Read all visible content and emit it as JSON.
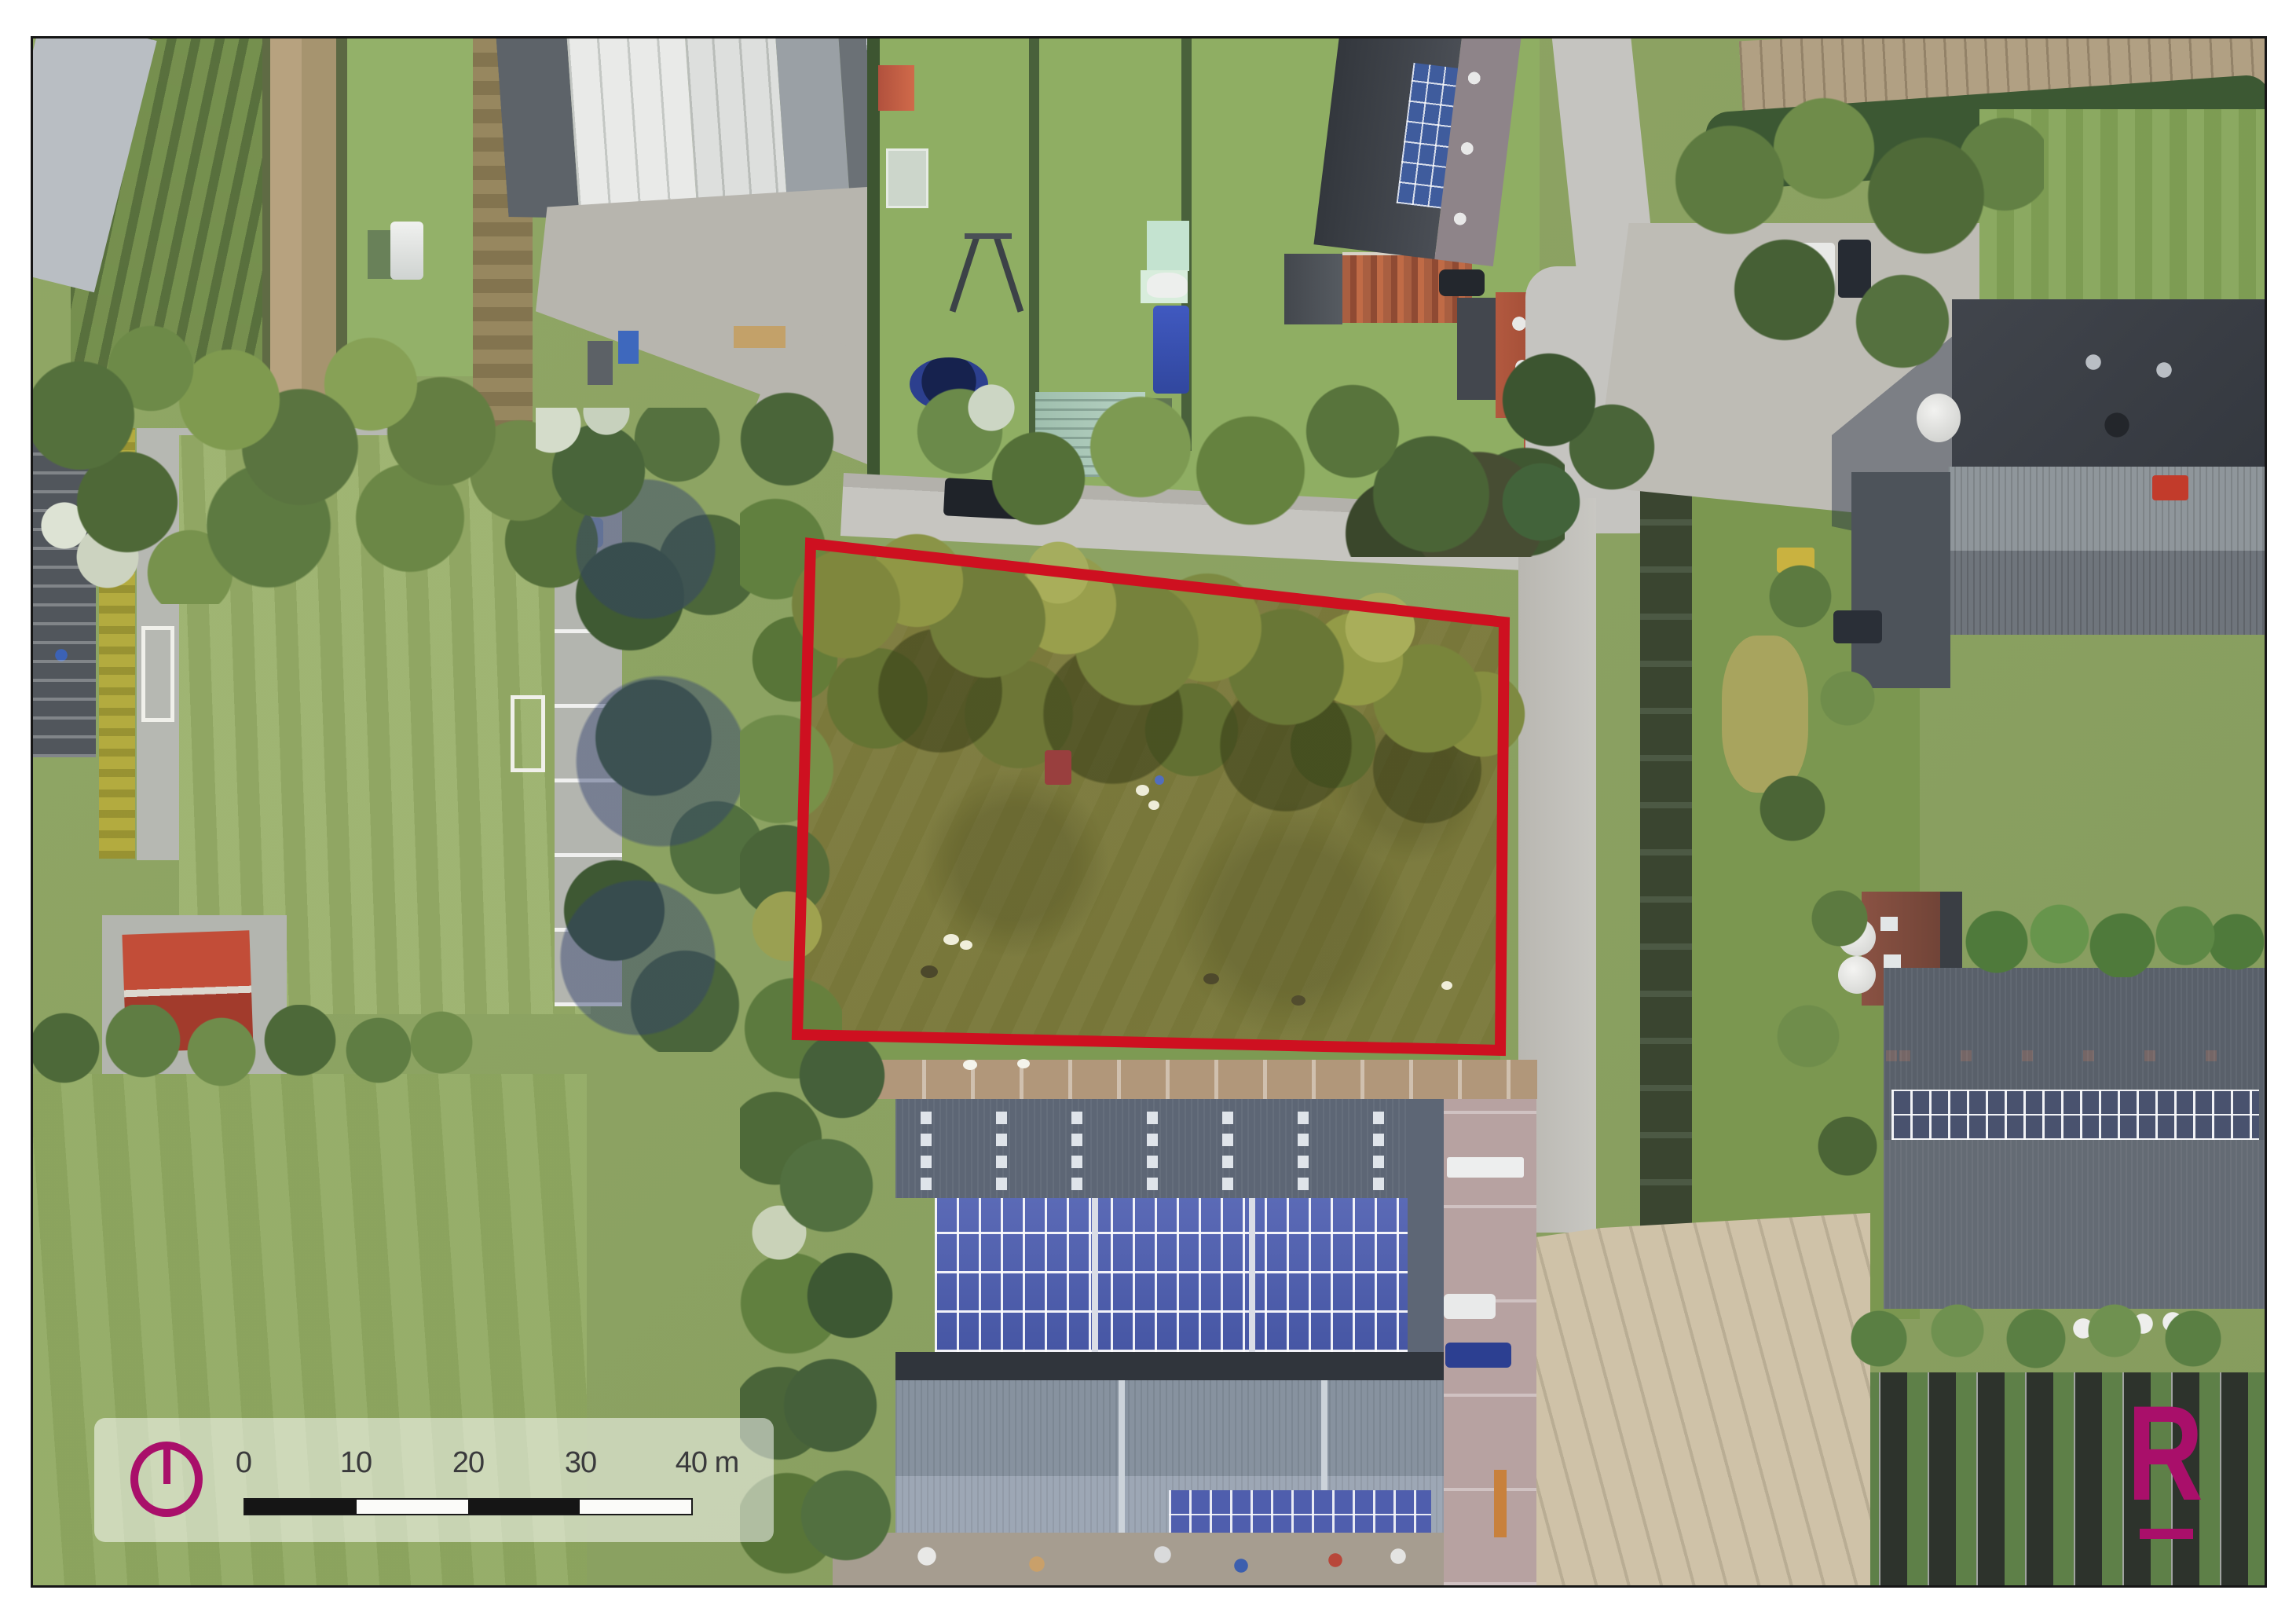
{
  "scalebar": {
    "ticks": [
      "0",
      "10",
      "20",
      "30",
      "40 m"
    ],
    "unit": "m",
    "segment_meters": 10
  },
  "logo": {
    "letter": "R"
  },
  "icons": {
    "north_arrow": "north-arrow-icon",
    "logo_mark": "letter-r-logo"
  },
  "colors": {
    "accent_magenta": "#a90f6a",
    "parcel_outline_red": "#ce1020",
    "scalebar_black": "#1a1a1a"
  }
}
